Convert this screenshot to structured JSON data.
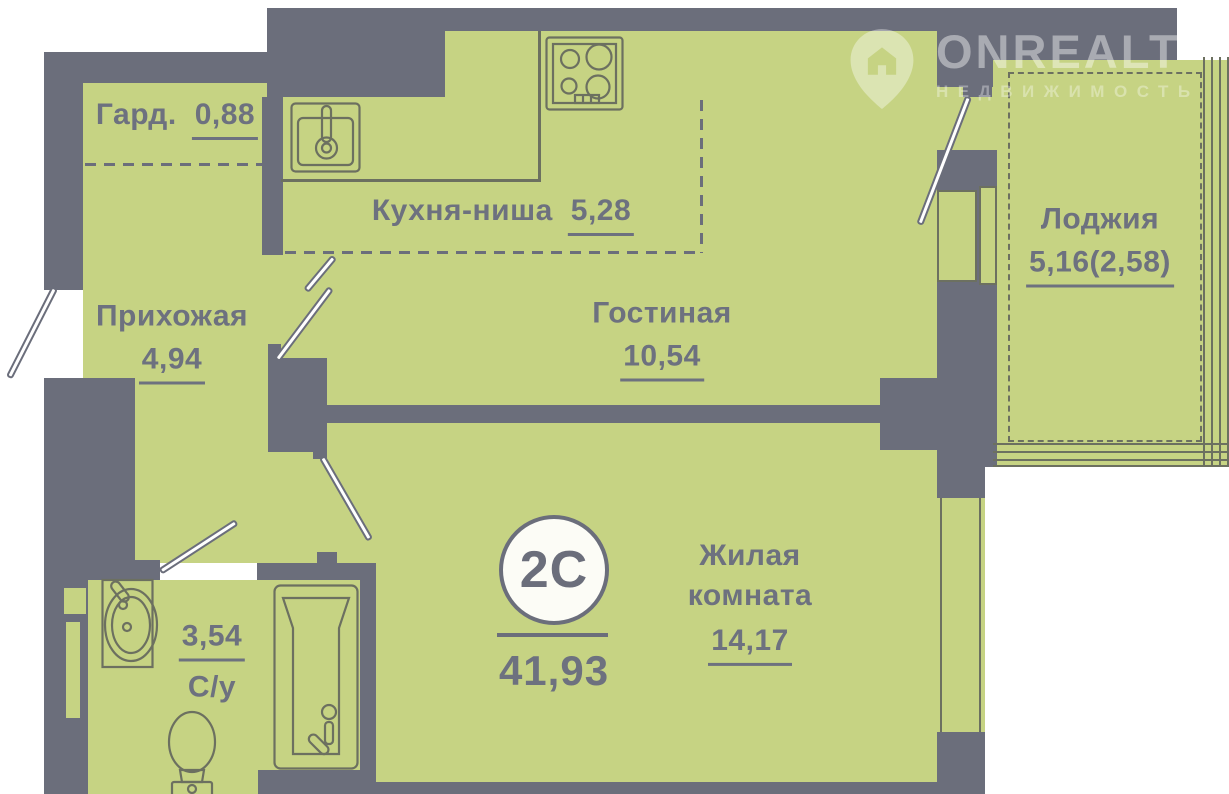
{
  "rooms": [
    {
      "name": "Гард.",
      "area": "0,88"
    },
    {
      "name": "Кухня-ниша",
      "area": "5,28"
    },
    {
      "name": "Прихожая",
      "area": "4,94"
    },
    {
      "name": "Гостиная",
      "area": "10,54"
    },
    {
      "name": "Лоджия",
      "area": "5,16(2,58)"
    },
    {
      "name": "Жилая комната",
      "area": "14,17"
    },
    {
      "name": "С/у",
      "area": "3,54"
    }
  ],
  "badge": {
    "type": "2С",
    "total_area": "41,93"
  },
  "watermark": {
    "brand": "ONREALT",
    "tagline": "НЕДВИЖИМОСТЬ"
  },
  "colors": {
    "wall": "#6b6e7b",
    "floor": "#c6d383",
    "line": "#6c7060",
    "text": "#6d717f",
    "badge_bg": "#fcfcf6"
  }
}
